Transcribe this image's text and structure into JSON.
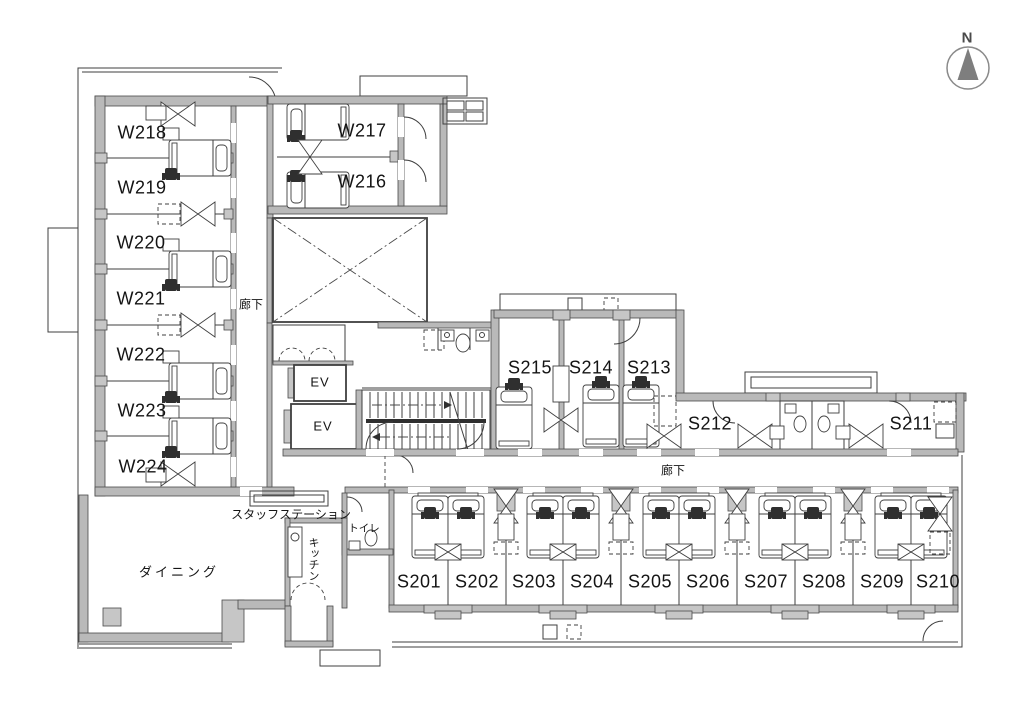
{
  "compass": {
    "north": "N"
  },
  "labels": {
    "corridor_west": "廊下",
    "corridor_south": "廊下",
    "dining": "ダイニング",
    "staff_station": "スタッフステーション",
    "kitchen": "キッチン",
    "toilet": "トイレ",
    "elevator_upper": "EV",
    "elevator_lower": "EV"
  },
  "rooms": {
    "west": [
      "W218",
      "W219",
      "W220",
      "W221",
      "W222",
      "W223",
      "W224"
    ],
    "north": [
      "W217",
      "W216"
    ],
    "south_upper": [
      "S215",
      "S214",
      "S213"
    ],
    "south_right": [
      "S212",
      "S211"
    ],
    "south_lower": [
      "S201",
      "S202",
      "S203",
      "S204",
      "S205",
      "S206",
      "S207",
      "S208",
      "S209",
      "S210"
    ]
  }
}
